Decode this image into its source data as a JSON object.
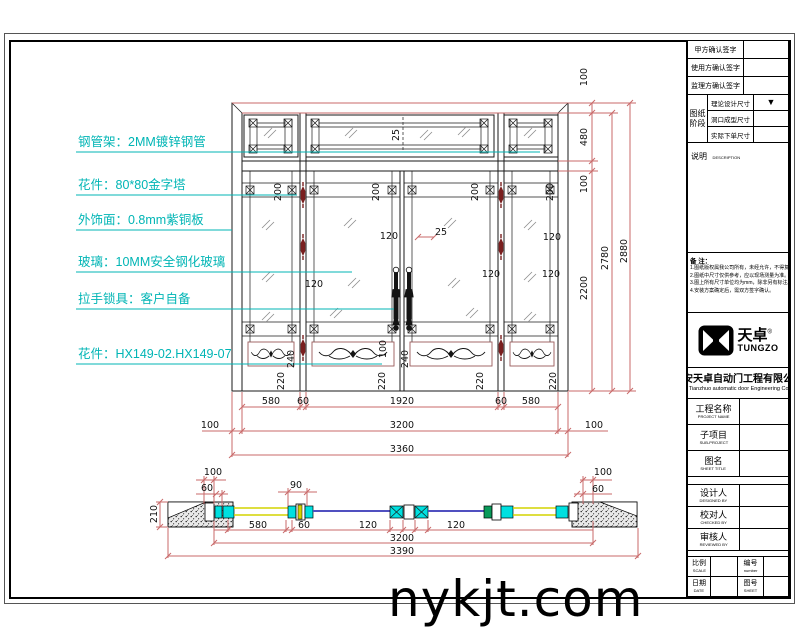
{
  "sheet": {
    "watermark": "nykjt.com"
  },
  "colors": {
    "annotation": "#00b5b5",
    "dimension_line": "#c96a6a",
    "hinge": "#7a1f1f",
    "plan_frame_fill": "#00e0e0",
    "plan_glass_line": "#5050c0",
    "plan_wood_line": "#d4d400",
    "plan_green_block": "#0a9a5a"
  },
  "annotations": {
    "items": [
      {
        "text": "钢管架：2MM镀锌钢管",
        "y": 146,
        "lx": 540
      },
      {
        "text": "花件：80*80金字塔",
        "y": 189,
        "lx": 297
      },
      {
        "text": "外饰面：0.8mm紫铜板",
        "y": 224,
        "lx": 232
      },
      {
        "text": "玻璃：10MM安全钢化玻璃",
        "y": 266,
        "lx": 352
      },
      {
        "text": "拉手锁具：客户自备",
        "y": 303,
        "lx": 394
      },
      {
        "text": "花件：HX149-02.HX149-07",
        "y": 358,
        "lx": 382
      }
    ]
  },
  "drawing": {
    "dims": [
      {
        "t": "100",
        "x": 587,
        "y": 77,
        "r": -90
      },
      {
        "t": "480",
        "x": 587,
        "y": 137,
        "r": -90
      },
      {
        "t": "100",
        "x": 587,
        "y": 184,
        "r": -90
      },
      {
        "t": "2200",
        "x": 587,
        "y": 288,
        "r": -90
      },
      {
        "t": "2780",
        "x": 608,
        "y": 258,
        "r": -90
      },
      {
        "t": "2880",
        "x": 627,
        "y": 251,
        "r": -90
      },
      {
        "t": "25",
        "x": 399,
        "y": 135,
        "r": -90
      },
      {
        "t": "200",
        "x": 281,
        "y": 192,
        "r": -90
      },
      {
        "t": "200",
        "x": 379,
        "y": 192,
        "r": -90
      },
      {
        "t": "200",
        "x": 478,
        "y": 192,
        "r": -90
      },
      {
        "t": "200",
        "x": 553,
        "y": 192,
        "r": -90
      },
      {
        "t": "120",
        "x": 314,
        "y": 287
      },
      {
        "t": "120",
        "x": 389,
        "y": 239
      },
      {
        "t": "25",
        "x": 441,
        "y": 235
      },
      {
        "t": "120",
        "x": 491,
        "y": 277
      },
      {
        "t": "120",
        "x": 552,
        "y": 240
      },
      {
        "t": "120",
        "x": 551,
        "y": 277
      },
      {
        "t": "100",
        "x": 386,
        "y": 349,
        "r": -90
      },
      {
        "t": "240",
        "x": 408,
        "y": 359,
        "r": -90
      },
      {
        "t": "240",
        "x": 294,
        "y": 359,
        "r": -90
      },
      {
        "t": "220",
        "x": 284,
        "y": 381,
        "r": -90
      },
      {
        "t": "220",
        "x": 385,
        "y": 381,
        "r": -90
      },
      {
        "t": "220",
        "x": 483,
        "y": 381,
        "r": -90
      },
      {
        "t": "220",
        "x": 556,
        "y": 381,
        "r": -90
      },
      {
        "t": "580",
        "x": 271,
        "y": 404
      },
      {
        "t": "60",
        "x": 303,
        "y": 404
      },
      {
        "t": "1920",
        "x": 402,
        "y": 404
      },
      {
        "t": "60",
        "x": 501,
        "y": 404
      },
      {
        "t": "580",
        "x": 531,
        "y": 404
      },
      {
        "t": "100",
        "x": 210,
        "y": 428
      },
      {
        "t": "3200",
        "x": 402,
        "y": 428
      },
      {
        "t": "100",
        "x": 594,
        "y": 428
      },
      {
        "t": "3360",
        "x": 402,
        "y": 452
      },
      {
        "t": "100",
        "x": 213,
        "y": 475
      },
      {
        "t": "60",
        "x": 207,
        "y": 491
      },
      {
        "t": "90",
        "x": 296,
        "y": 488
      },
      {
        "t": "100",
        "x": 603,
        "y": 475
      },
      {
        "t": "60",
        "x": 598,
        "y": 492
      },
      {
        "t": "580",
        "x": 258,
        "y": 528
      },
      {
        "t": "60",
        "x": 304,
        "y": 528
      },
      {
        "t": "120",
        "x": 368,
        "y": 528
      },
      {
        "t": "120",
        "x": 456,
        "y": 528
      },
      {
        "t": "3200",
        "x": 402,
        "y": 541
      },
      {
        "t": "3390",
        "x": 402,
        "y": 554
      },
      {
        "t": "210",
        "x": 157,
        "y": 514,
        "r": -90
      }
    ]
  },
  "title_block": {
    "sign_rows": [
      "甲方确认签字",
      "使用方确认签字",
      "监理方确认签字"
    ],
    "stage_label_1": "图纸",
    "stage_label_2": "阶段",
    "stage_rows": [
      "理论设计尺寸",
      "洞口成型尺寸",
      "实际下单尺寸"
    ],
    "stage_marker": "▼",
    "description_cn": "说明",
    "description_en": "DESCRIPTION",
    "notes_title": "备  注：",
    "notes": [
      "1.图纸版权属我公司所有，未经允许，不得复制。",
      "2.图纸中尺寸仅供参考，应以现场测量为准。",
      "3.图上所有尺寸单位均为mm，除非另有标注。",
      "4.安装方案确定后，需双方签字确认。"
    ],
    "logo_cn": "天卓",
    "logo_reg": "®",
    "logo_en": "TUNGZO",
    "company_cn": "西安天卓自动门工程有限公司",
    "company_en": "Xi'an Tianzhuo automatic door Engineering Co. Ltd.",
    "fields": [
      {
        "cn": "工程名称",
        "en": "PROJECT NAME"
      },
      {
        "cn": "子项目",
        "en": "SUB-PROJECT"
      },
      {
        "cn": "图名",
        "en": "SHEET TITLE"
      }
    ],
    "people": [
      {
        "cn": "设计人",
        "en": "DESIGNED BY"
      },
      {
        "cn": "校对人",
        "en": "CHECKED BY"
      },
      {
        "cn": "审核人",
        "en": "REVIEWED BY"
      }
    ],
    "footer": [
      {
        "cn": "比例",
        "en": "SCALE"
      },
      {
        "cn": "编号",
        "en": "number"
      },
      {
        "cn": "日期",
        "en": "DATE"
      },
      {
        "cn": "图号",
        "en": "SHEET"
      }
    ]
  }
}
